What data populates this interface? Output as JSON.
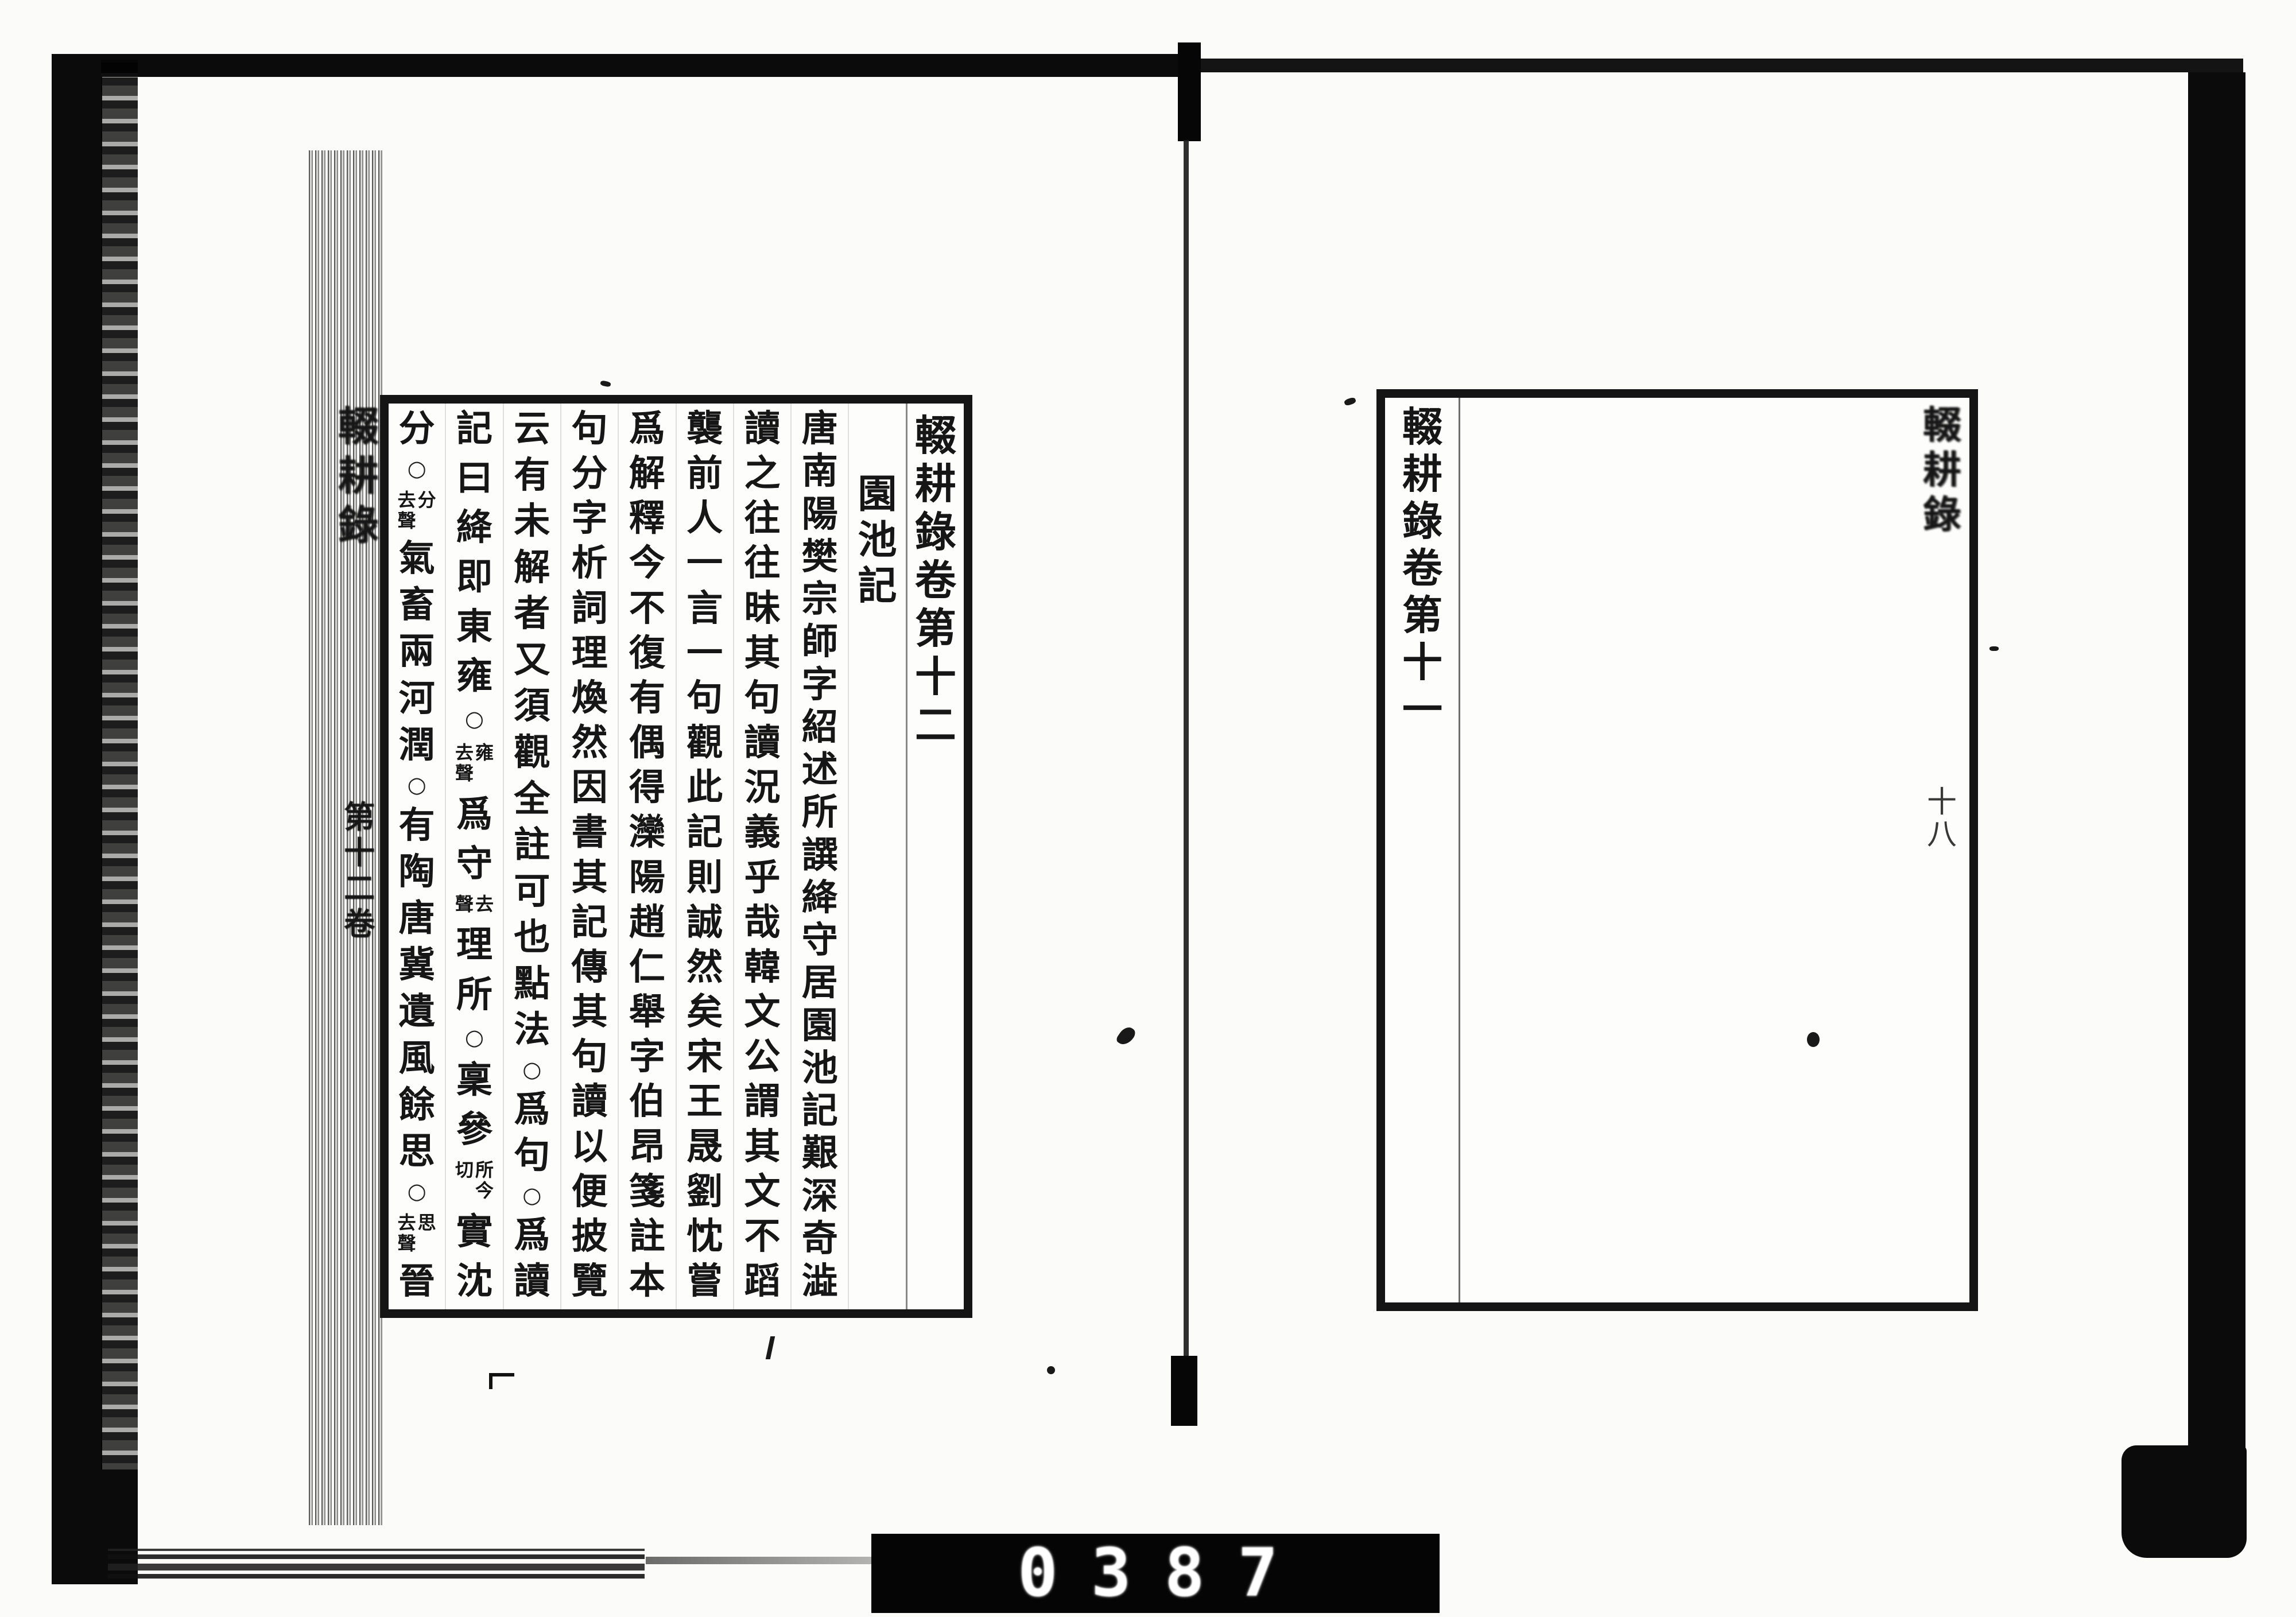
{
  "left_page": {
    "fold_title": "輟耕錄",
    "fold_volume": "第十二卷",
    "columns": [
      {
        "kind": "volume-title",
        "segs": [
          {
            "b": "輟耕錄卷第十二"
          }
        ]
      },
      {
        "kind": "heading",
        "segs": [
          {
            "b": "園池記"
          }
        ]
      },
      {
        "kind": "text",
        "segs": [
          {
            "b": "唐南陽樊宗師字紹述所譔絳守居園池記艱深奇澁"
          }
        ]
      },
      {
        "kind": "text",
        "segs": [
          {
            "b": "讀之往往昧其句讀況義乎哉韓文公謂其文不蹈"
          }
        ]
      },
      {
        "kind": "text",
        "segs": [
          {
            "b": "襲前人一言一句觀此記則誠然矣宋王晟劉忱嘗"
          }
        ]
      },
      {
        "kind": "text",
        "segs": [
          {
            "b": "爲解釋今不復有偶得灤陽趙仁舉字伯昂箋註本"
          }
        ]
      },
      {
        "kind": "text",
        "segs": [
          {
            "b": "句分字析詞理煥然因書其記傳其句讀以便披覽"
          }
        ]
      },
      {
        "kind": "text",
        "segs": [
          {
            "b": "云有未解者又須觀全註可也點法"
          },
          {
            "c": "○"
          },
          {
            "b": "爲句"
          },
          {
            "c": "○"
          },
          {
            "b": "爲讀"
          }
        ]
      },
      {
        "kind": "text",
        "segs": [
          {
            "b": "記曰絳即東雍"
          },
          {
            "c": "○"
          },
          {
            "s": [
              "雍",
              "去聲"
            ]
          },
          {
            "b": "爲守"
          },
          {
            "s": [
              "去",
              "聲"
            ]
          },
          {
            "b": "理所"
          },
          {
            "c": "○"
          },
          {
            "b": "稟參"
          },
          {
            "s": [
              "所今",
              "切"
            ]
          },
          {
            "b": "實沈"
          }
        ]
      },
      {
        "kind": "text",
        "segs": [
          {
            "b": "分"
          },
          {
            "c": "○"
          },
          {
            "s": [
              "分",
              "去聲"
            ]
          },
          {
            "b": "氣畜兩河潤"
          },
          {
            "c": "○"
          },
          {
            "b": "有陶唐冀遺風餘思"
          },
          {
            "c": "○"
          },
          {
            "s": [
              "思",
              "去聲"
            ]
          },
          {
            "b": "晉"
          }
        ]
      }
    ]
  },
  "right_page": {
    "closing_column": "輟耕錄卷第十一",
    "fold_title": "輟耕錄",
    "folio_number": "十八"
  },
  "counter": {
    "digits": "0387"
  }
}
